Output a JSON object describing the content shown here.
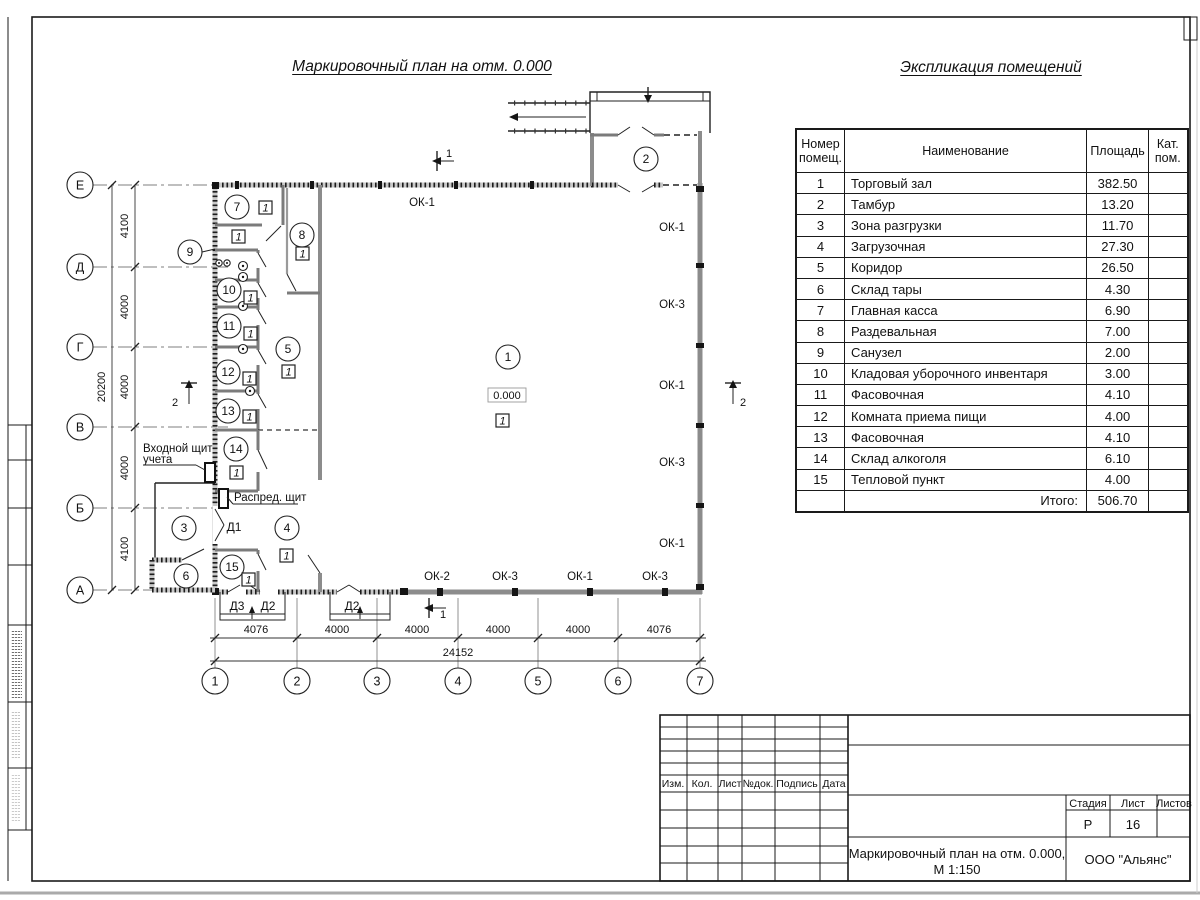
{
  "sheet": {
    "plan_title": "Маркировочный план на отм. 0.000",
    "table_title": "Экспликация помещений"
  },
  "plan": {
    "elevation": "0.000",
    "unit_marker": "1",
    "axes": {
      "vertical": [
        "Е",
        "Д",
        "Г",
        "В",
        "Б",
        "А"
      ],
      "horizontal": [
        "1",
        "2",
        "3",
        "4",
        "5",
        "6",
        "7"
      ]
    },
    "dims": {
      "left": [
        "4100",
        "4000",
        "4000",
        "4000",
        "4100"
      ],
      "left_total": "20200",
      "bottom": [
        "4076",
        "4000",
        "4000",
        "4000",
        "4000",
        "4076"
      ],
      "bottom_total": "24152"
    },
    "windows": {
      "top": "ОК-1",
      "right": [
        "ОК-1",
        "ОК-3",
        "ОК-1",
        "ОК-3",
        "ОК-1"
      ],
      "bottom": [
        "ОК-2",
        "ОК-3",
        "ОК-1",
        "ОК-3"
      ]
    },
    "doors": {
      "d1": "Д1",
      "d2": "Д2",
      "d3": "Д3"
    },
    "sections": {
      "s1": "1",
      "s2": "2"
    },
    "rooms": [
      "1",
      "2",
      "3",
      "4",
      "5",
      "6",
      "7",
      "8",
      "9",
      "10",
      "11",
      "12",
      "13",
      "14",
      "15"
    ],
    "annotations": {
      "entry_panel_line1": "Входной щит",
      "entry_panel_line2": "учета",
      "distribution_panel": "Распред. щит"
    }
  },
  "table": {
    "headers": {
      "num": "Номер помещ.",
      "name": "Наименование",
      "area": "Площадь",
      "cat": "Кат. пом."
    },
    "rows": [
      {
        "num": "1",
        "name": "Торговый зал",
        "area": "382.50"
      },
      {
        "num": "2",
        "name": "Тамбур",
        "area": "13.20"
      },
      {
        "num": "3",
        "name": "Зона разгрузки",
        "area": "11.70"
      },
      {
        "num": "4",
        "name": "Загрузочная",
        "area": "27.30"
      },
      {
        "num": "5",
        "name": "Коридор",
        "area": "26.50"
      },
      {
        "num": "6",
        "name": "Склад тары",
        "area": "4.30"
      },
      {
        "num": "7",
        "name": "Главная касса",
        "area": "6.90"
      },
      {
        "num": "8",
        "name": "Раздевальная",
        "area": "7.00"
      },
      {
        "num": "9",
        "name": "Санузел",
        "area": "2.00"
      },
      {
        "num": "10",
        "name": "Кладовая уборочного инвентаря",
        "area": "3.00"
      },
      {
        "num": "11",
        "name": "Фасовочная",
        "area": "4.10"
      },
      {
        "num": "12",
        "name": "Комната приема пищи",
        "area": "4.00"
      },
      {
        "num": "13",
        "name": "Фасовочная",
        "area": "4.10"
      },
      {
        "num": "14",
        "name": "Склад алкоголя",
        "area": "6.10"
      },
      {
        "num": "15",
        "name": "Тепловой пункт",
        "area": "4.00"
      }
    ],
    "total_label": "Итого:",
    "total_value": "506.70"
  },
  "titleblock": {
    "revision_headers": [
      "Изм.",
      "Кол.",
      "Лист",
      "№док.",
      "Подпись",
      "Дата"
    ],
    "stage_label": "Стадия",
    "sheet_label": "Лист",
    "sheets_label": "Листов",
    "stage_value": "Р",
    "sheet_value": "16",
    "doc_title_line1": "Маркировочный план на отм. 0.000,",
    "doc_title_line2": "М 1:150",
    "company": "ООО \"Альянс\""
  }
}
